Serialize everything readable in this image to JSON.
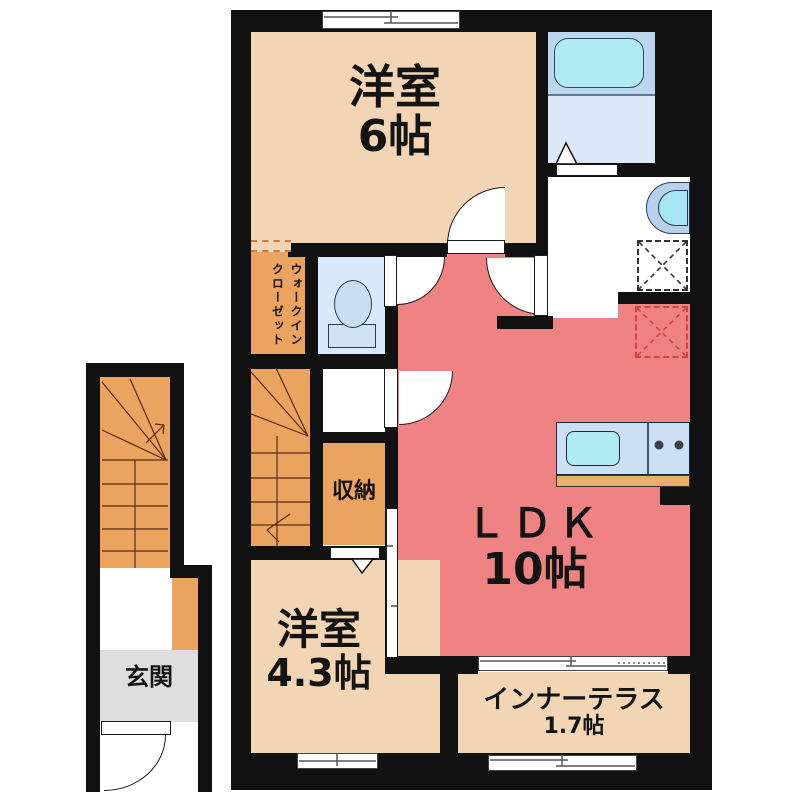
{
  "rooms": {
    "bedroom6": {
      "name": "洋室",
      "size": "6帖"
    },
    "ldk": {
      "name": "ＬＤＫ",
      "size": "10帖"
    },
    "bedroom43": {
      "name": "洋室",
      "size": "4.3帖"
    },
    "inner_terrace": {
      "name": "インナーテラス",
      "size": "1.7帖"
    },
    "storage": {
      "name": "収納"
    },
    "entrance": {
      "name": "玄関"
    },
    "walk_in_closet": {
      "name_col1": "ウォークイン",
      "name_col2": "クローゼット"
    }
  },
  "fixtures": [
    "bathtub-icon",
    "bathroom",
    "wash-basin-icon",
    "toilet-icon",
    "kitchen-sink-icon",
    "stove-burners-icon",
    "washing-machine-space",
    "refrigerator-space",
    "staircase-external",
    "staircase-internal",
    "entrance-door",
    "sliding-windows",
    "hinged-doors"
  ],
  "colors": {
    "room_beige": "#f2d5b5",
    "accent_orange": "#eaa45f",
    "ldk_red": "#ef8383",
    "entrance_gray": "#dedede",
    "water_room_blue": "#d9ebfa",
    "bath_zone_blue": "#bdd6f0",
    "bath_floor_blue": "#dde9f8",
    "fixture_cyan": "#b0ebf4",
    "counter_blue": "#cbdff5",
    "counter_wood": "#e9ad6c",
    "wall": "#111111"
  }
}
